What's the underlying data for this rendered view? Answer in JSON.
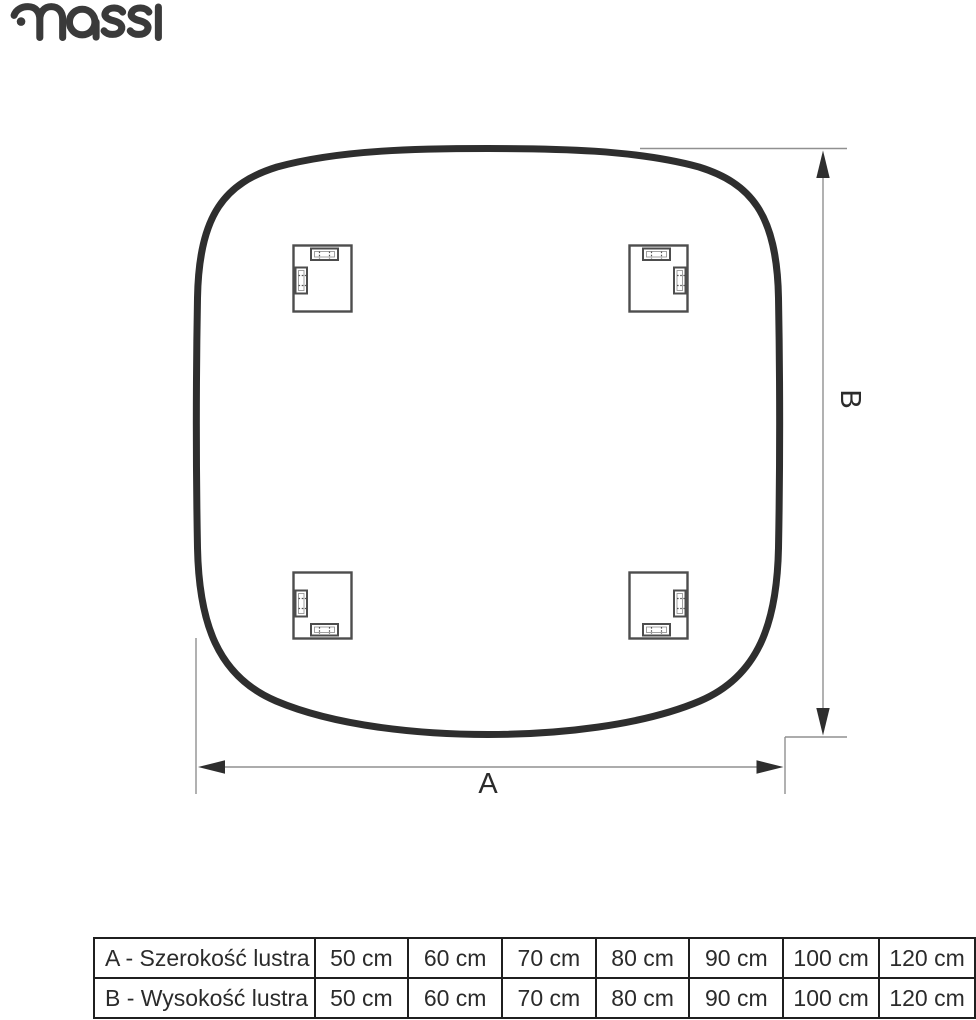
{
  "logo": {
    "brand": "massi"
  },
  "diagram": {
    "label_a": "A",
    "label_b": "B",
    "mirror_shape": "rounded-square mirror rear view with 4 mounting brackets",
    "colors": {
      "outline": "#2e2e2e",
      "dimension_line": "#909090",
      "arrowhead": "#2e2e2e",
      "bracket": "#4d4d4d",
      "table_border": "#1f1f1f",
      "text": "#2b2b2b",
      "logo": "#3a3a3a"
    }
  },
  "table": {
    "rows": [
      {
        "label": "A - Szerokość lustra",
        "values": [
          "50 cm",
          "60 cm",
          "70 cm",
          "80 cm",
          "90 cm",
          "100 cm",
          "120 cm"
        ]
      },
      {
        "label": "B - Wysokość lustra",
        "values": [
          "50 cm",
          "60 cm",
          "70 cm",
          "80 cm",
          "90 cm",
          "100 cm",
          "120 cm"
        ]
      }
    ]
  }
}
